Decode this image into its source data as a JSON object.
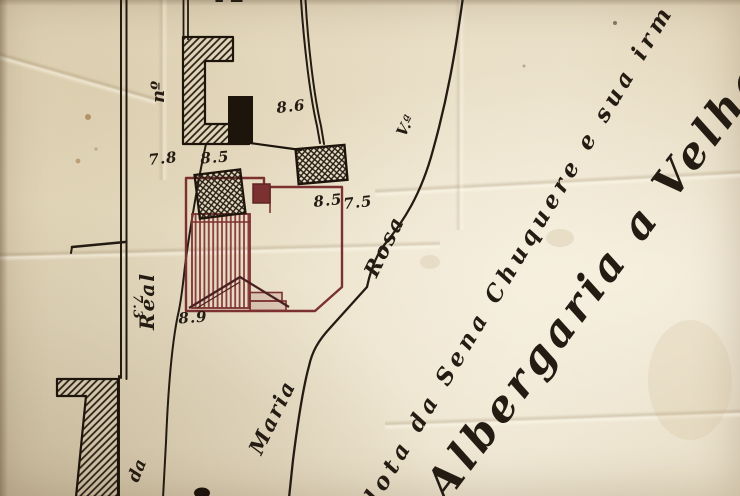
{
  "colors": {
    "paper": "#e9dfc9",
    "ink": "#241b12",
    "red": "#7c3131"
  },
  "labels": {
    "partial_letter": "A",
    "numero": "nº",
    "n86": "8.6",
    "n78": "7.8",
    "n85_top": "8.5",
    "n85_mid": "8.5",
    "n75": "7.5",
    "n73": "7.3",
    "n89": "8.9",
    "real": "Real",
    "va": "V.ª",
    "rosa": "Rosa",
    "maria": "Maria",
    "da": "da",
    "inscription_small": "lota da Sena Chuquere e sua irm",
    "inscription_large": "Albergaria a Velha"
  }
}
